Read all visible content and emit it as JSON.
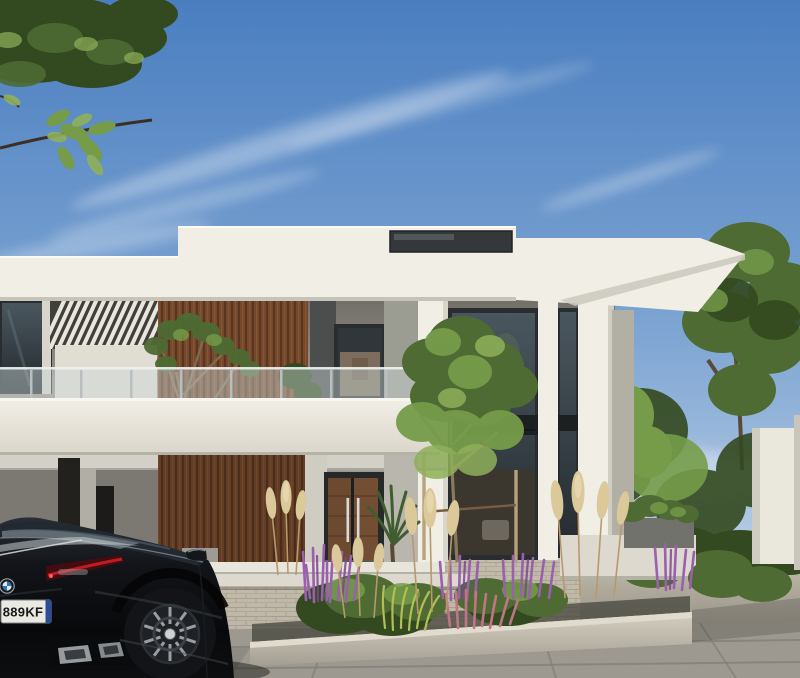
{
  "scene": {
    "type": "architectural-exterior-rendering",
    "subject": "modern two-storey white villa with wood slat accents, landscaped garden and black coupe parked on driveway"
  },
  "car": {
    "plate": "889KF",
    "brand": "bmw-roundel"
  },
  "objects": [
    "sky-with-cirrus-clouds",
    "overhanging-tree-foliage",
    "flat-roof-parapet",
    "clerestory-window",
    "pergola-slats",
    "wood-slat-wall",
    "glass-balcony-railing",
    "balcony-slab",
    "balcony-tree",
    "double-height-windows",
    "white-pilasters",
    "entrance-double-doors",
    "palm-plant",
    "entry-steps",
    "raised-planter-bed",
    "salvia-flowers",
    "pampas-grass",
    "ornamental-shrubs",
    "young-tree-with-stakes",
    "garden-trees",
    "garden-wall",
    "brick-paved-driveway",
    "stone-slab-paving",
    "black-coupe-car"
  ],
  "colors": {
    "sky_top": "#4a7ec0",
    "sky_mid": "#7fa6d3",
    "sky_low": "#b9cde4",
    "sky_horizon": "#d8e3ef",
    "cloud_white": "#ffffff",
    "wall_white": "#f1eee5",
    "wall_lit": "#e0ddd3",
    "wall_shade": "#c6c3b9",
    "soffit": "#d3d0c7",
    "recess_top": "#6f6d66",
    "recess_bottom": "#9e9b92",
    "ground_dark": "#67655f",
    "ground_light": "#a5a299",
    "slab_top": "#f2efe7",
    "slab_bottom": "#d9d5c9",
    "wood_dark": "#53331f",
    "wood_mid": "#75482c",
    "wood_light": "#8d5c38",
    "frame_dark": "#2a2d2f",
    "glass_top": "#4a565e",
    "glass_bottom": "#242b2f",
    "glass_rail": "#ccd6d8",
    "rail_post": "#b9bfc0",
    "interior_warm": "#8a7763",
    "interior_dark": "#3b372f",
    "concrete_top": "#d5cfc0",
    "concrete_bottom": "#a49f93",
    "curb_top": "#e0dbcc",
    "paver_brick": "#c4bcab",
    "brick_joint": "#a89f8e",
    "slab_pave": "#9d9990",
    "pave_joint": "#827f76",
    "pave_top": "#c7c0af",
    "pave_mid": "#a39e92",
    "pave_low": "#7f7c75",
    "foliage_dark": "#33491f",
    "foliage_mid": "#4e6b33",
    "foliage_light": "#769c4a",
    "foliage_bright": "#8fb05a",
    "trunk_brown": "#6b4f38",
    "branch_dark": "#3a2f22",
    "palm_green": "#3f5d30",
    "salvia_purple": "#9a5fae",
    "heather_pink": "#c17483",
    "grass_yellow": "#b3bf52",
    "pampas": "#dcc99a",
    "pampas_stem": "#b89a6a",
    "car_top": "#2a2f35",
    "car_black": "#08090b",
    "car_glass": "#222930",
    "car_reflect": "#c9cfd2",
    "tail_red": "#c01b24",
    "tail_dark": "#420c10",
    "plate_bg": "#e9eae2",
    "plate_text": "#17181a",
    "plate_blue": "#2b4b9b",
    "rim_silver": "#999ea3",
    "exhaust_silver": "#969ba0"
  }
}
